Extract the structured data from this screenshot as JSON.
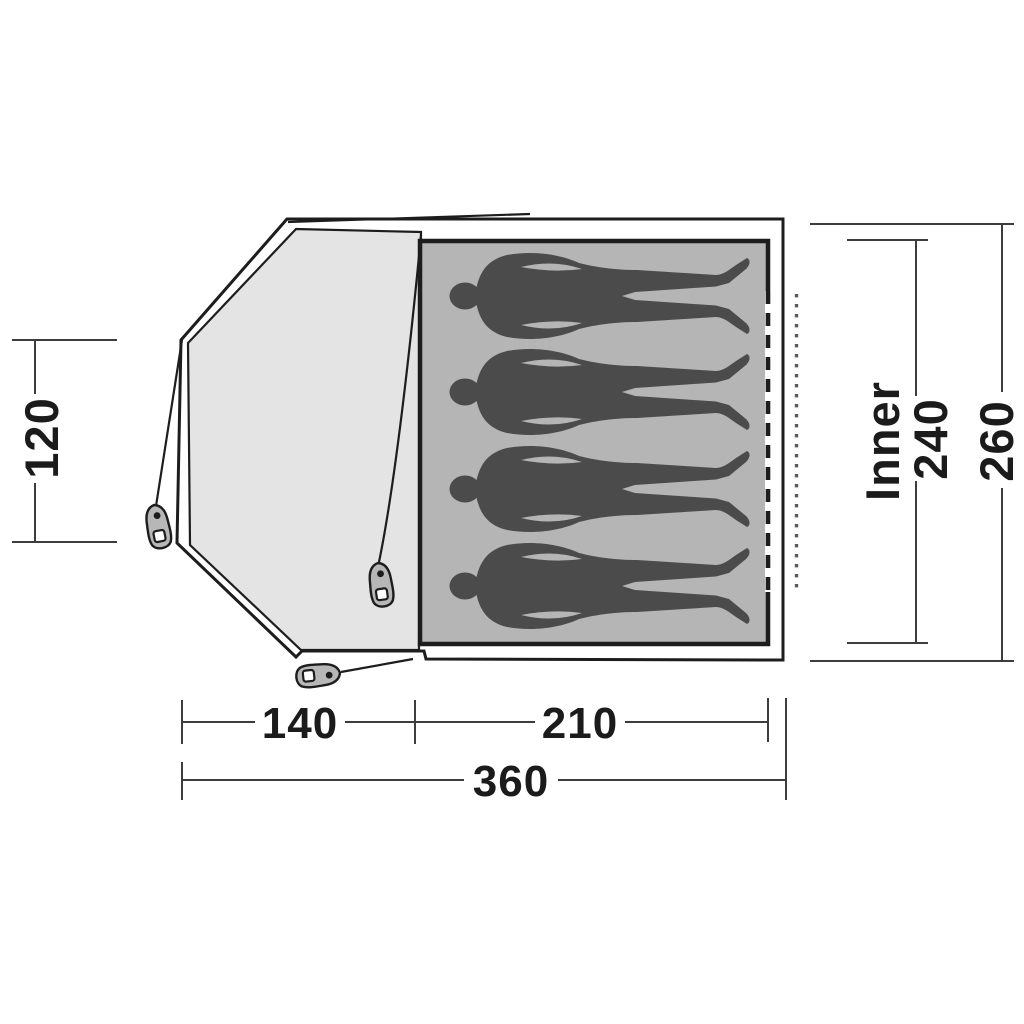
{
  "diagram": {
    "description": "Tent floor plan with porch and inner sleeping area",
    "sleeping_capacity": 4,
    "dimension_labels": {
      "porch_depth": "120",
      "porch_length": "140",
      "inner_length": "210",
      "total_length": "360",
      "inner_label": "Inner",
      "inner_width": "240",
      "total_width": "260"
    },
    "colors": {
      "line": "#1d1d1d",
      "dim_line": "#3d3d3d",
      "text": "#1b1b1b",
      "porch_fill": "#e4e4e4",
      "inner_fill": "#b5b5b5",
      "figure_fill": "#4b4b4b",
      "peg_fill": "#b7b7b7",
      "dot_line": "#5a5a5a",
      "background": "#ffffff"
    }
  }
}
